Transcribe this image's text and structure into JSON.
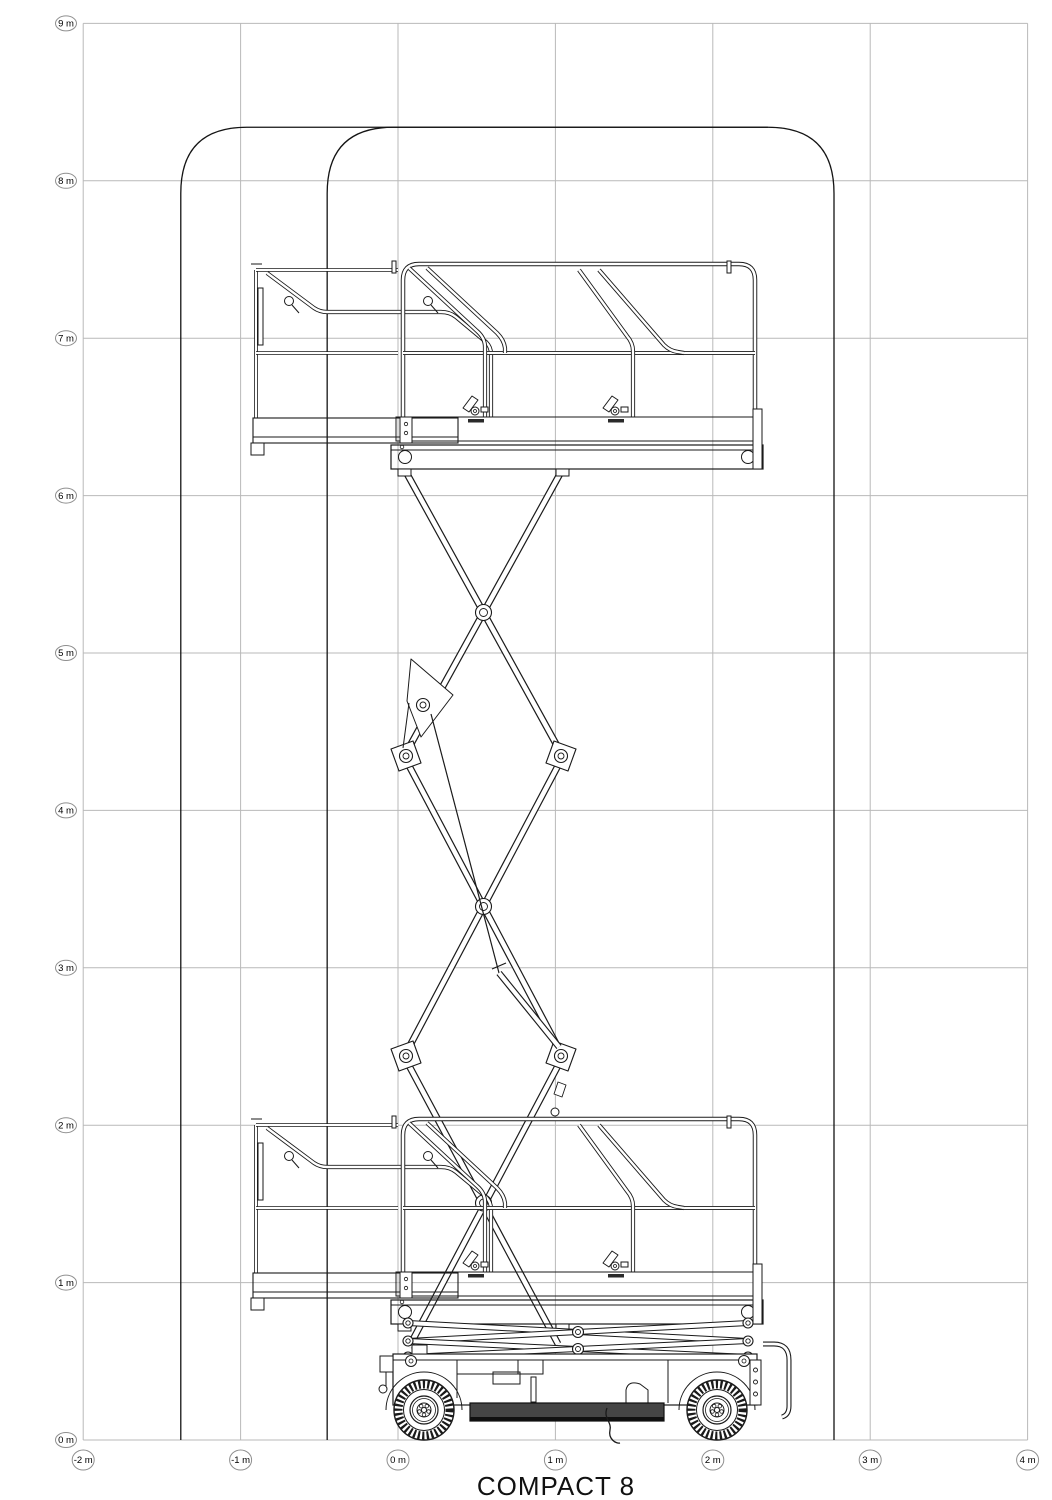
{
  "title": "COMPACT 8",
  "colors": {
    "background": "#ffffff",
    "grid_line": "#b9b9b9",
    "drawing_line": "#1a1a1a",
    "envelope_line": "#141414",
    "label_ellipse_stroke": "#8f8f8f",
    "label_text": "#000000",
    "skirt_fill": "#454545",
    "skirt_edge": "#101010"
  },
  "axes": {
    "px_per_m": 157.4,
    "origin_px": {
      "x": 398,
      "y": 1440
    },
    "x_range_m": [
      -2,
      4
    ],
    "y_range_m": [
      0,
      9
    ],
    "x_ticks": [
      {
        "m": -2,
        "label": "-2 m"
      },
      {
        "m": -1,
        "label": "-1 m"
      },
      {
        "m": 0,
        "label": "0 m"
      },
      {
        "m": 1,
        "label": "1 m"
      },
      {
        "m": 2,
        "label": "2 m"
      },
      {
        "m": 3,
        "label": "3 m"
      },
      {
        "m": 4,
        "label": "4 m"
      }
    ],
    "y_ticks": [
      {
        "m": 0,
        "label": "0 m"
      },
      {
        "m": 1,
        "label": "1 m"
      },
      {
        "m": 2,
        "label": "2 m"
      },
      {
        "m": 3,
        "label": "3 m"
      },
      {
        "m": 4,
        "label": "4 m"
      },
      {
        "m": 5,
        "label": "5 m"
      },
      {
        "m": 6,
        "label": "6 m"
      },
      {
        "m": 7,
        "label": "7 m"
      },
      {
        "m": 8,
        "label": "8 m"
      },
      {
        "m": 9,
        "label": "9 m"
      }
    ]
  },
  "envelopes": [
    {
      "name": "working-envelope-deck-extended",
      "left_m": -1.38,
      "right_m": 2.77,
      "top_m": 8.34,
      "corner_r_m": 0.42
    },
    {
      "name": "working-envelope-deck-retracted",
      "left_m": -0.45,
      "right_m": 2.77,
      "top_m": 8.34,
      "corner_r_m": 0.42
    }
  ]
}
